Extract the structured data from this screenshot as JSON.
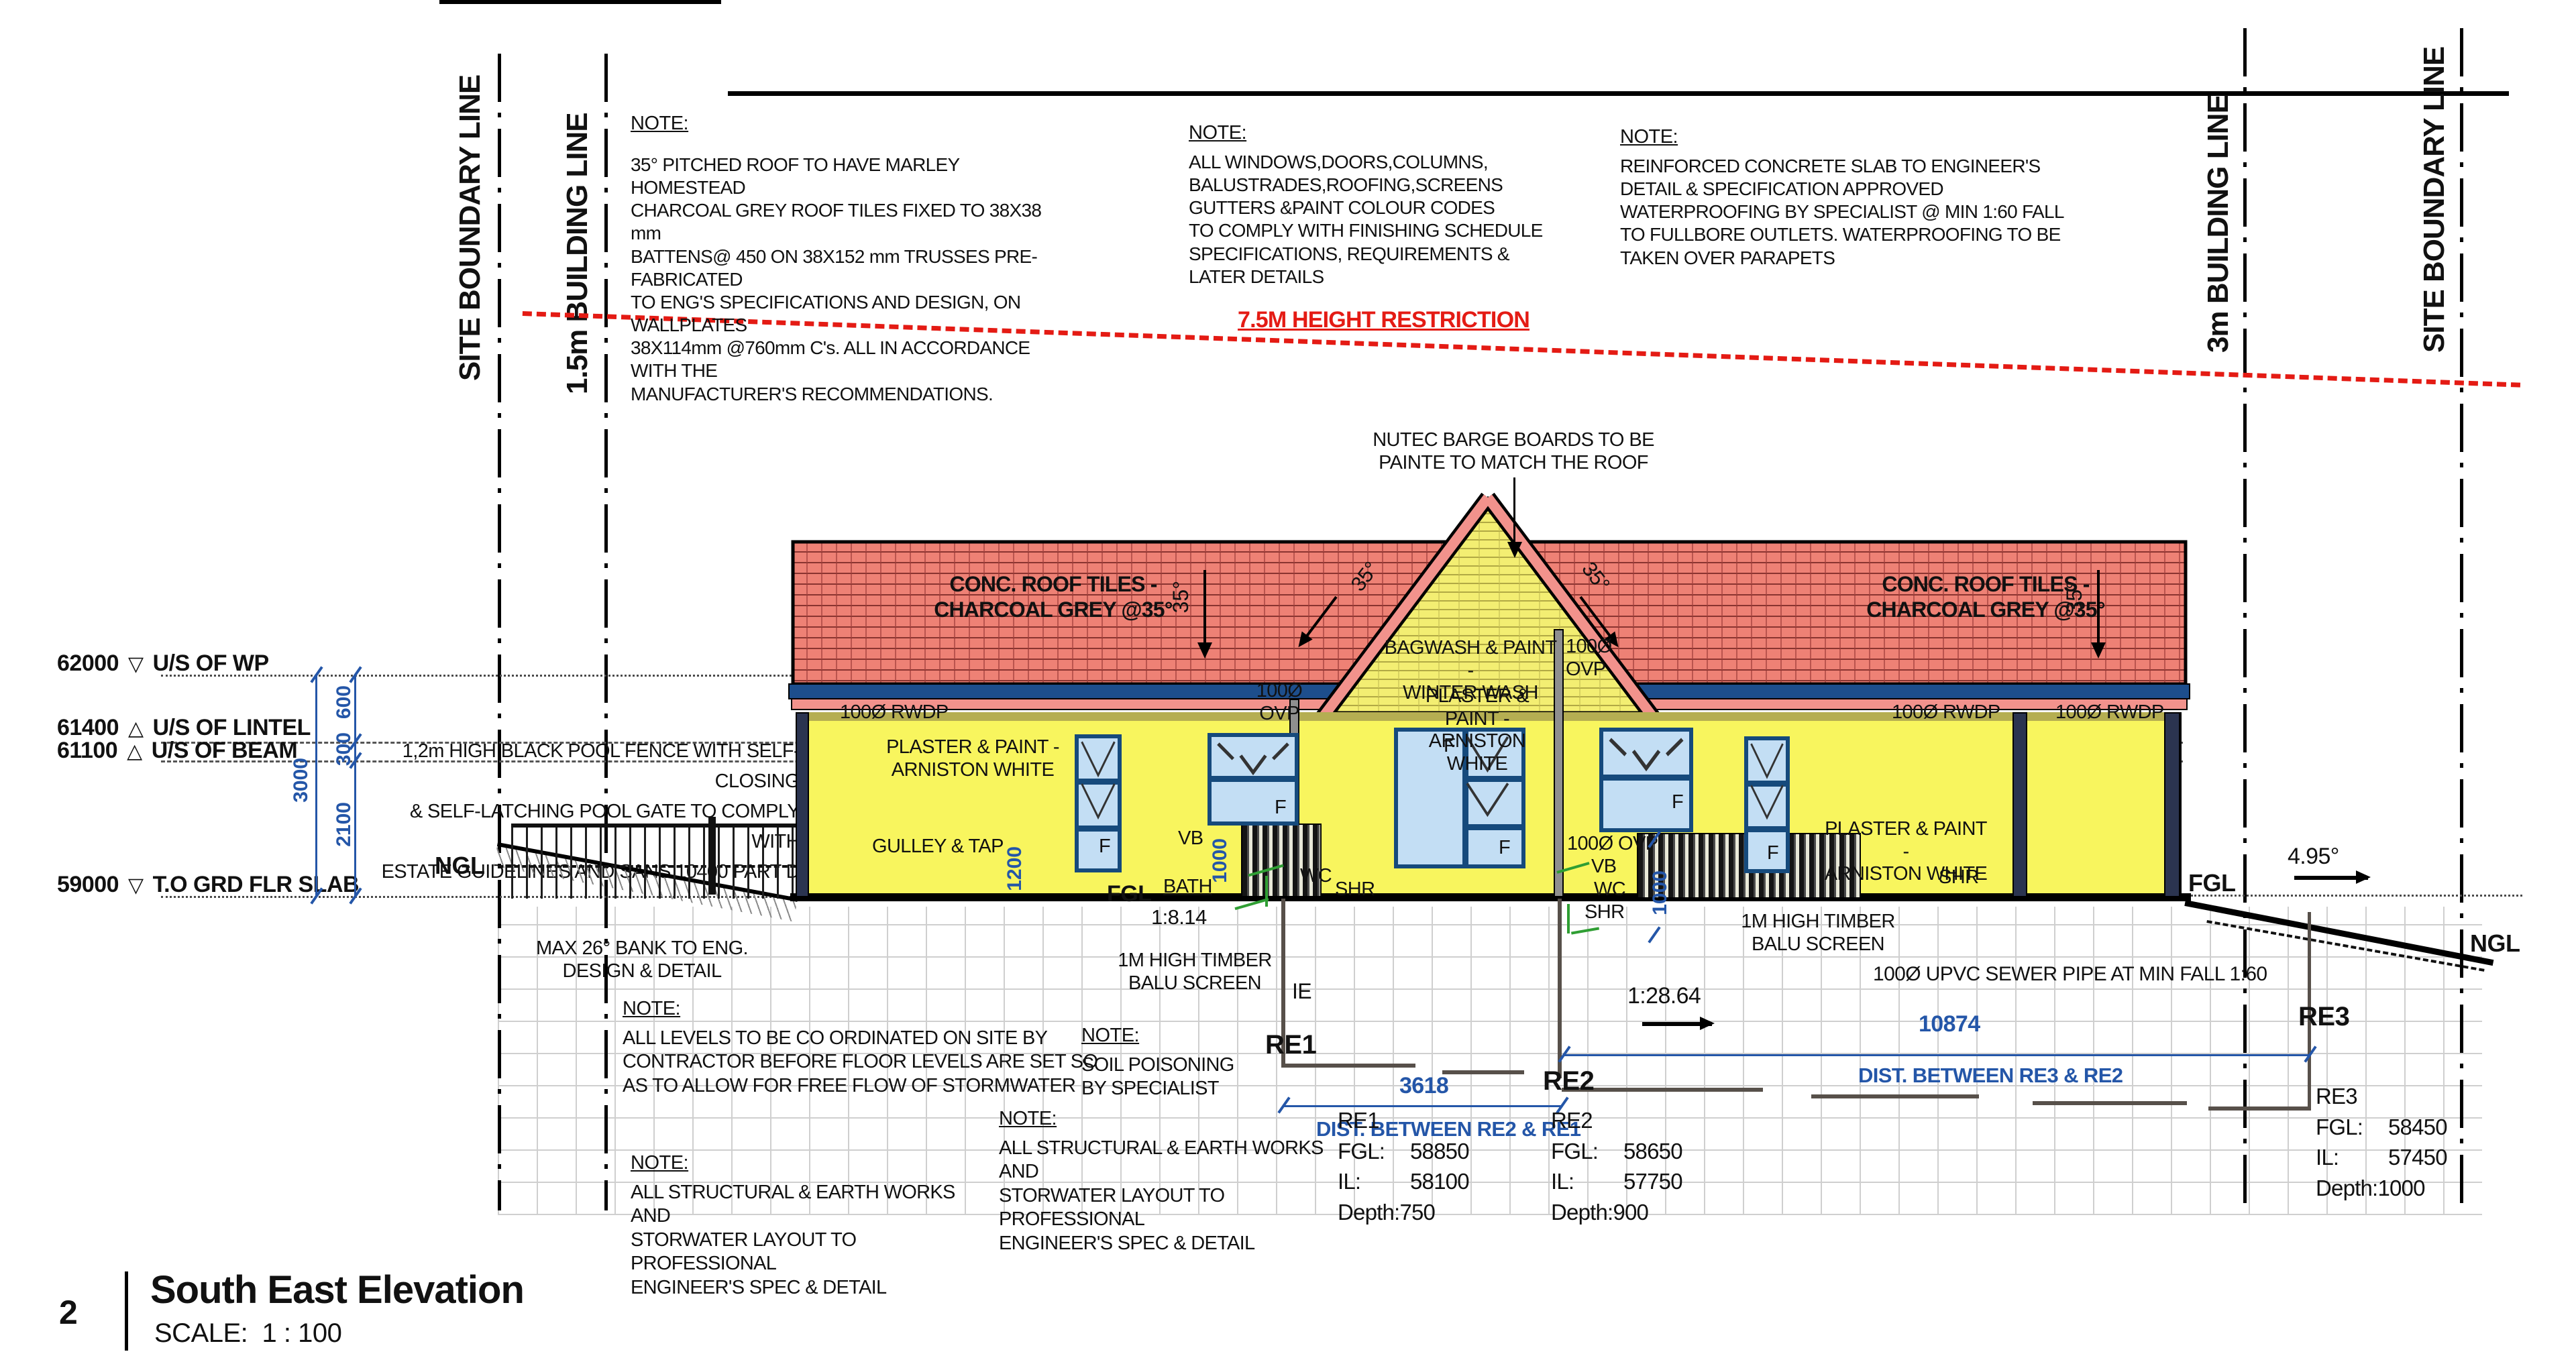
{
  "title_block": {
    "sheet_number": "2",
    "title": "South East Elevation",
    "scale_label": "SCALE:",
    "scale_value": "1 : 100"
  },
  "boundary_lines": {
    "left_site": "SITE BOUNDARY LINE",
    "left_building": "1.5m BUILDING  LINE",
    "right_building": "3m BUILDING  LINE",
    "right_site": "SITE BOUNDARY LINE"
  },
  "height_restriction": "7.5M HEIGHT RESTRICTION",
  "notes": {
    "roof": {
      "heading": "NOTE:",
      "body": [
        "35° PITCHED ROOF TO HAVE MARLEY HOMESTEAD",
        "CHARCOAL GREY ROOF TILES FIXED TO 38X38 mm",
        "BATTENS@ 450 ON 38X152 mm TRUSSES PRE-FABRICATED",
        "TO ENG'S SPECIFICATIONS AND DESIGN, ON WALLPLATES",
        "38X114mm @760mm C's. ALL IN ACCORDANCE WITH THE",
        "MANUFACTURER'S RECOMMENDATIONS."
      ]
    },
    "windows": {
      "heading": "NOTE:",
      "body": [
        "ALL WINDOWS,DOORS,COLUMNS,",
        "BALUSTRADES,ROOFING,SCREENS",
        "GUTTERS &PAINT COLOUR CODES",
        "TO COMPLY WITH FINISHING SCHEDULE",
        "SPECIFICATIONS,  REQUIREMENTS &",
        "LATER DETAILS"
      ]
    },
    "slab": {
      "heading": "NOTE:",
      "body": [
        "REINFORCED CONCRETE SLAB TO ENGINEER'S",
        "DETAIL & SPECIFICATION APPROVED",
        "WATERPROOFING BY SPECIALIST @ MIN 1:60 FALL",
        "TO FULLBORE OUTLETS. WATERPROOFING TO BE",
        "TAKEN OVER PARAPETS"
      ]
    },
    "levels": {
      "heading": "NOTE:",
      "body": [
        "ALL LEVELS TO BE CO ORDINATED ON SITE BY",
        "CONTRACTOR BEFORE FLOOR LEVELS ARE SET SO",
        "AS TO ALLOW FOR FREE FLOW OF STORMWATER"
      ]
    },
    "soil": {
      "heading": "NOTE:",
      "body": [
        "SOIL POISONING",
        "BY SPECIALIST"
      ]
    },
    "structural1": {
      "heading": "NOTE:",
      "body": [
        "ALL STRUCTURAL & EARTH WORKS AND",
        "STORWATER LAYOUT TO PROFESSIONAL",
        "ENGINEER'S SPEC & DETAIL"
      ]
    },
    "structural2": {
      "heading": "NOTE:",
      "body": [
        "ALL STRUCTURAL & EARTH WORKS AND",
        "STORWATER LAYOUT TO PROFESSIONAL",
        "ENGINEER'S SPEC & DETAIL"
      ]
    }
  },
  "levels": [
    {
      "value": "62000",
      "marker": "▽",
      "label": "U/S OF WP"
    },
    {
      "value": "61400",
      "marker": "△",
      "label": "U/S OF LINTEL"
    },
    {
      "value": "61100",
      "marker": "△",
      "label": "U/S OF BEAM"
    },
    {
      "value": "59000",
      "marker": "▽",
      "label": "T.O GRD FLR SLAB"
    }
  ],
  "dims": {
    "d600": "600",
    "d300": "300",
    "d3000": "3000",
    "d2100": "2100",
    "d1200": "1200",
    "d1000a": "1000",
    "d1000b": "1000",
    "d3618": "3618",
    "d10874": "10874",
    "dist_re2_re1": "DIST. BETWEEN RE2 & RE1",
    "dist_re3_re2": "DIST. BETWEEN RE3 & RE2"
  },
  "re_points": [
    {
      "name": "RE1",
      "fgl_key": "FGL:",
      "fgl": "58850",
      "il_key": "IL:",
      "il": "58100",
      "depth_key": "Depth:",
      "depth": "750"
    },
    {
      "name": "RE2",
      "fgl_key": "FGL:",
      "fgl": "58650",
      "il_key": "IL:",
      "il": "57750",
      "depth_key": "Depth:",
      "depth": "900"
    },
    {
      "name": "RE3",
      "fgl_key": "FGL:",
      "fgl": "58450",
      "il_key": "IL:",
      "il": "57450",
      "depth_key": "Depth:",
      "depth": "1000"
    }
  ],
  "labels": {
    "nutec": [
      "NUTEC BARGE BOARDS TO BE",
      "PAINTE TO MATCH THE ROOF"
    ],
    "conc_tiles": [
      "CONC. ROOF TILES -",
      "CHARCOAL GREY @35°"
    ],
    "deg35": "35°",
    "bagwash": [
      "BAGWASH & PAINT -",
      "WINTER WASH"
    ],
    "plaster": [
      "PLASTER & PAINT -",
      "ARNISTON WHITE"
    ],
    "ovp_2line": [
      "100Ø",
      "OVP"
    ],
    "ovp_1line": "100Ø OVP",
    "rwdp": "100Ø RWDP",
    "gulley": "GULLEY & TAP",
    "pool_fence": [
      "1,2m HIGH BLACK POOL FENCE WITH SELF-CLOSING",
      "& SELF-LATCHING POOL GATE TO COMPLY WITH",
      "ESTATE GUIDELINES AND SANS 10400 PART D"
    ],
    "max_bank": [
      "MAX 26° BANK TO ENG.",
      "DESIGN & DETAIL"
    ],
    "timber_screen": [
      "1M HIGH TIMBER",
      "BALU SCREEN"
    ],
    "sewer_pipe": "100Ø UPVC SEWER PIPE AT MIN FALL 1:60",
    "ngl": "NGL",
    "fgl": "FGL",
    "vb": "VB",
    "bath": "BATH",
    "wc": "WC",
    "shr": "SHR",
    "f": "F",
    "ie": "IE",
    "fall_814": "1:8.14",
    "fall_2864": "1:28.64",
    "deg_495": "4.95°"
  }
}
